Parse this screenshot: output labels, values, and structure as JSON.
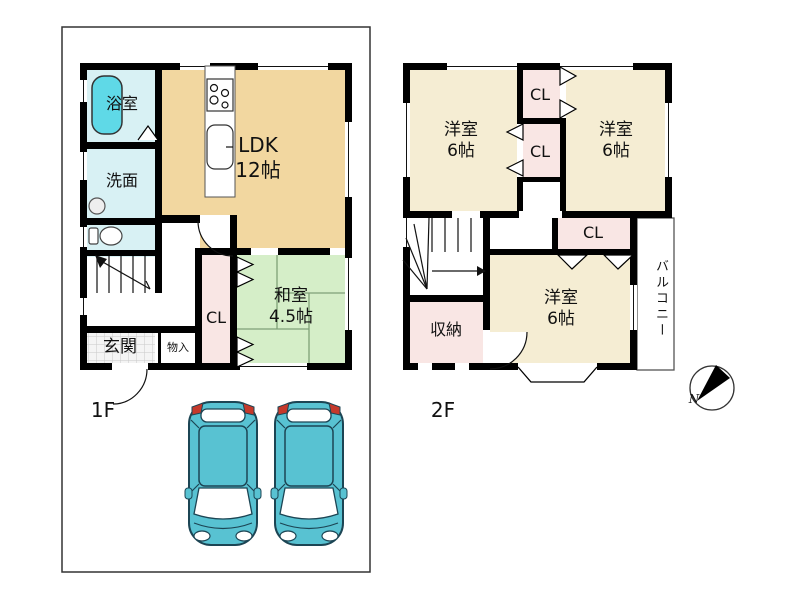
{
  "floor1": {
    "label": "1F",
    "rooms": {
      "bath": {
        "label": "浴室"
      },
      "washroom": {
        "label": "洗面"
      },
      "ldk": {
        "name": "LDK",
        "size": "12帖"
      },
      "closet": {
        "label": "CL"
      },
      "washitsu": {
        "name": "和室",
        "size": "4.5帖"
      },
      "genkan": {
        "label": "玄関"
      },
      "storage": {
        "label": "物入"
      }
    }
  },
  "floor2": {
    "label": "2F",
    "rooms": {
      "bedroom1": {
        "name": "洋室",
        "size": "6帖"
      },
      "bedroom2": {
        "name": "洋室",
        "size": "6帖"
      },
      "bedroom3": {
        "name": "洋室",
        "size": "6帖"
      },
      "closet1": {
        "label": "CL"
      },
      "closet2": {
        "label": "CL"
      },
      "closet3": {
        "label": "CL"
      },
      "storage": {
        "label": "収納"
      },
      "balcony": {
        "label": "バルコニー"
      }
    }
  },
  "compass": {
    "north": "N"
  },
  "parking": {
    "car_count": 2
  },
  "colors": {
    "wall": "#000000",
    "ldk": "#F2D7A0",
    "bedroom": "#F5EDD3",
    "closet": "#F9E6E4",
    "tatami": "#D5EEC8",
    "tatami_line": "#7FA077",
    "wet_room": "#D8F1F4",
    "bathtub": "#5FD9E7",
    "car_body": "#58C2D2",
    "car_outline": "#1C4554",
    "tail_light": "#C5392B",
    "lot_line": "#333333"
  }
}
